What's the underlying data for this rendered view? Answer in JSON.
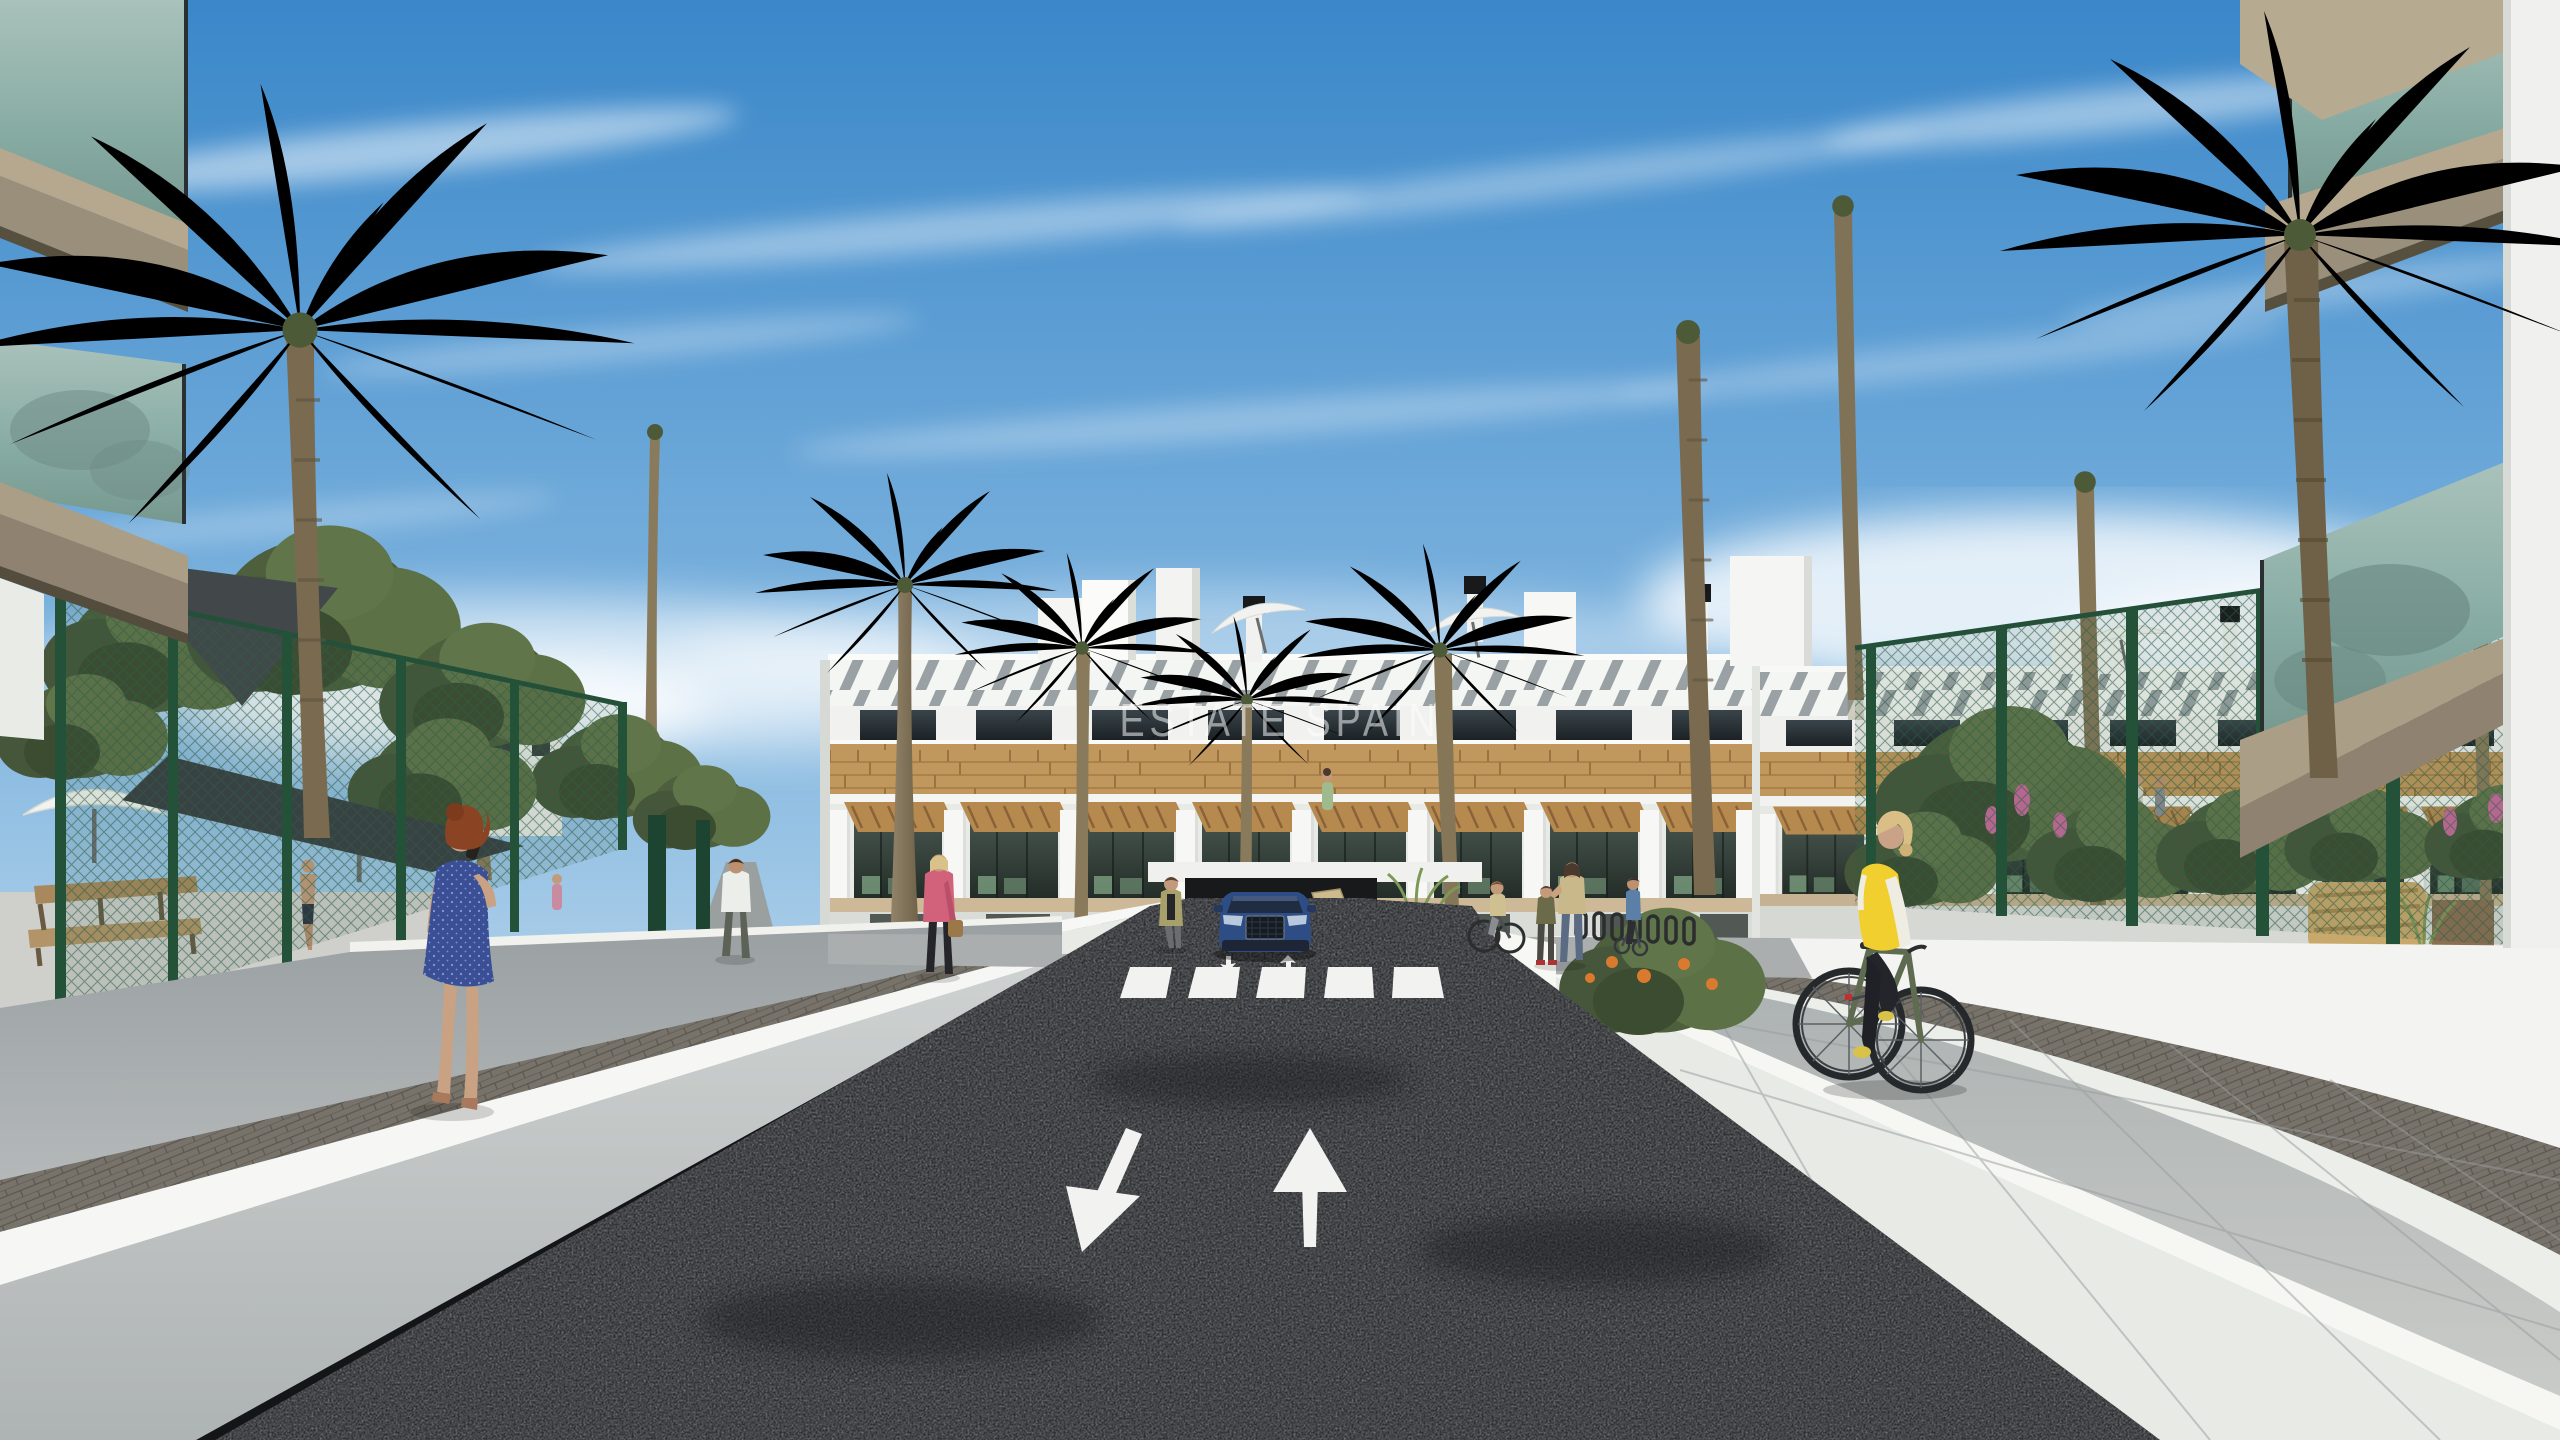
{
  "watermark": {
    "text": "ESTATE SPAIN",
    "color": "#ffffff"
  },
  "scene": {
    "type": "architectural-3d-render",
    "setting": "sunny day, new-build Mediterranean apartment complex with palm-lined private street",
    "sky": {
      "top": "#3a87c9",
      "horizon": "#dcebf4",
      "clouds": "wispy cirrus streaks and low bright cumulus"
    },
    "building": {
      "style": "modern white 3-storey apartment block",
      "features": [
        "rooftop solariums with white pergola slats",
        "black chimney caps",
        "white parasols on roof terraces",
        "wood-clad band",
        "terraces with wooden pergolas",
        "underground car-park entrance"
      ],
      "colors": {
        "walls": "#f3f5f2",
        "wood": "#c0975c",
        "glazing": "#222b27",
        "pergola_slats": "#9aa1a4",
        "slab_band": "#cdb897"
      }
    },
    "foreground_buildings": {
      "left": "balcony corners with green glass railings and beige slabs",
      "right": "balcony corners with green glass railings, white pillar"
    },
    "road": {
      "surface": "dark asphalt, sunken two-way lane",
      "color": "#2c2e31",
      "marking_color": "#f2f3f1",
      "markings": [
        "large arrow toward viewer (left lane)",
        "large arrow away from viewer (right lane)",
        "zebra crossing of five stripes",
        "two small arrows at garage ramp"
      ]
    },
    "walls": {
      "color": "#f2f3f0",
      "description": "white retaining walls with sunlit caps flanking the road, paver gutter strips along deck edges"
    },
    "fences": {
      "color": "#2c5a42",
      "description": "dark-green mesh fence panels on both sides"
    },
    "vegetation": {
      "palms": 13,
      "shrubs": "dense green bushes left side, garden shrubs right side",
      "flowers": [
        "orange",
        "pink"
      ],
      "lawn": "#6d7f4a"
    },
    "amenities": {
      "left": "pool terrace behind fence with white parasols, dark shade sails, wooden bench",
      "right": "garden lounge with rattan sofa and table"
    },
    "vehicle": {
      "type": "SUV exiting underground car park",
      "color": "#2f4d85"
    },
    "people": [
      {
        "id": "woman-blue-dress",
        "desc": "red-haired woman in blue polka-dot dress phoning, walking on left deck",
        "accent": "#3b4f96"
      },
      {
        "id": "cyclist-yellow-vest",
        "desc": "blonde woman in yellow vest on green bicycle, right promenade",
        "accent": "#f0cf2e"
      },
      {
        "id": "woman-pink-jacket",
        "desc": "woman in pink jacket with handbag on garden path",
        "accent": "#d2617c"
      },
      {
        "id": "man-white-tshirt",
        "desc": "man in white t-shirt walking up the garden path"
      },
      {
        "id": "mother-and-child",
        "desc": "mother with child near bike racks"
      },
      {
        "id": "woman-on-bicycle-racks",
        "desc": "woman cycling near bike racks"
      },
      {
        "id": "person-scooter",
        "desc": "person with scooter near racks"
      },
      {
        "id": "woman-near-ramp",
        "desc": "woman standing beside garage ramp"
      },
      {
        "id": "man-pool",
        "desc": "shirtless man in pool area behind left fence"
      },
      {
        "id": "residents-on-terraces",
        "desc": "small figures on building terraces"
      }
    ]
  }
}
